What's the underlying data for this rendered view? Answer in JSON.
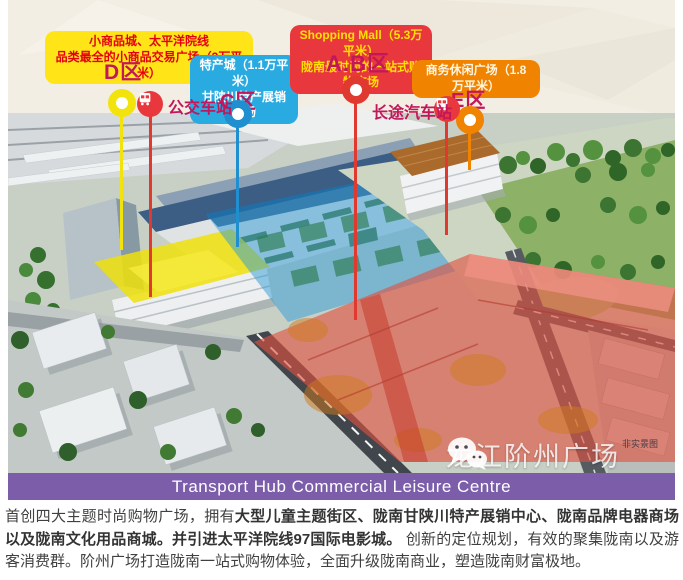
{
  "graphic": {
    "banner": {
      "title": "Transport Hub Commercial Leisure Centre",
      "bg_color": "#7b5da9"
    },
    "watermark": {
      "brand": "龙江阶州广场",
      "note": "非实景图",
      "icon": "wechat-icon"
    },
    "legend": {
      "zone_label_color": "#c2185b",
      "d": {
        "line1": "小商品城、太平洋院线",
        "line2": "品类最全的小商品交易广场（3万平米）",
        "zone": "D区",
        "bg": "#ffe417",
        "fg": "#e50012",
        "marker": "#f3e30c"
      },
      "c": {
        "line1": "特产城（1.1万平米）",
        "line2": "甘陕川特产展销广场",
        "zone": "C区",
        "bg": "#29abe2",
        "fg": "#ffffff",
        "marker": "#1f8fd0"
      },
      "ab": {
        "line1": "Shopping Mall（5.3万平米）",
        "line2": "陇南最时尚的一站式购物广场",
        "zone": "A.B区",
        "bg": "#e8383d",
        "fg": "#ffe100",
        "marker": "#e0392f"
      },
      "e": {
        "line1": "商务休闲广场（1.8万平米）",
        "zone": "E区",
        "bg": "#f08300",
        "fg": "#fff6e0",
        "marker": "#f08300"
      },
      "bus_stop": {
        "label": "公交车站"
      },
      "coach_station": {
        "label": "长途汽车站"
      }
    }
  },
  "description": {
    "seg1": "首创四大主题时尚购物广场，拥有",
    "seg2_bold": "大型儿童主题街区、陇南甘陕川特产展销中心、陇南品牌电器商场以及陇南文化用品商城。并引进太平洋院线97国际电影城。",
    "seg3": " 创新的定位规划，有效的聚集陇南以及游客消费群。阶州广场打造陇南一站式购物体验，全面升级陇南商业，塑造陇南财富极地。"
  }
}
